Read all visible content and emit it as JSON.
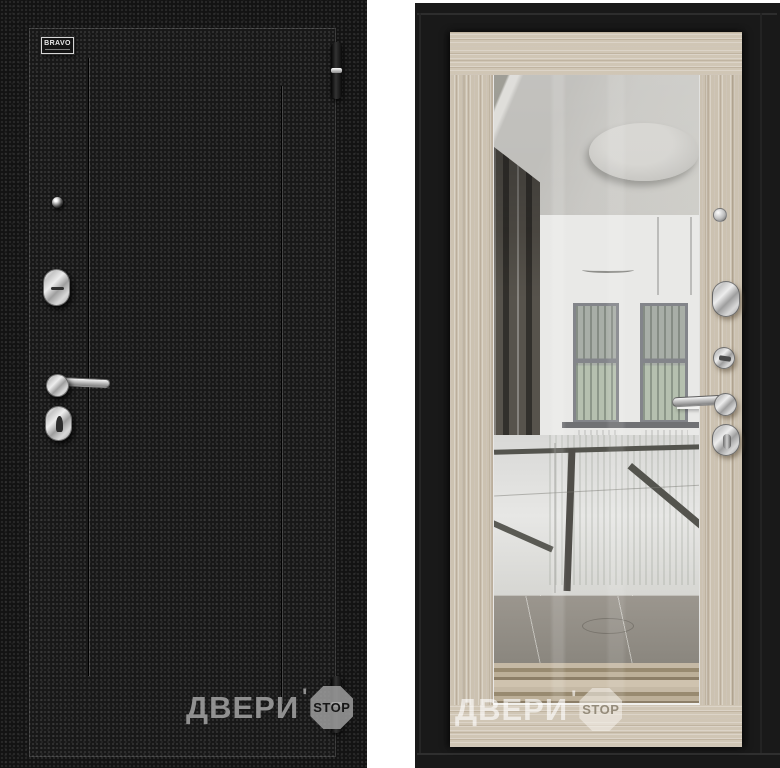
{
  "product_photo": {
    "brand_badge_text": "BRAVO"
  },
  "watermark": {
    "brand_text": "ДВЕРИ",
    "apostrophe": "'",
    "stop_text": "STOP"
  },
  "colors": {
    "exterior_finish_black": "#171717",
    "interior_wood_cappuccino": "#ccc2b1",
    "frame_black": "#191919",
    "hardware_chrome": "#cfcfcf",
    "divider_white": "#ffffff",
    "mirror_ceiling_gray": "#c6c5c1"
  }
}
